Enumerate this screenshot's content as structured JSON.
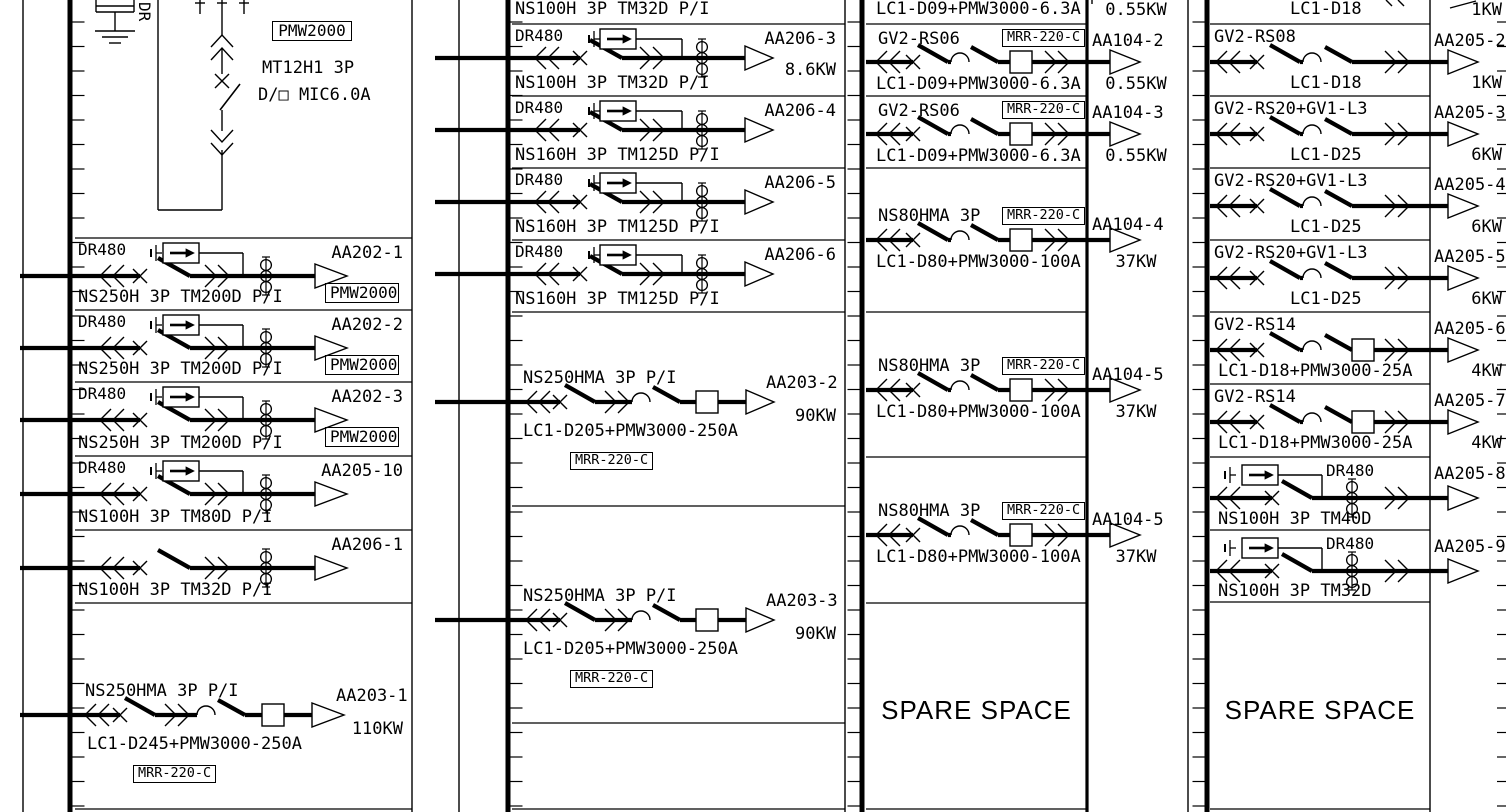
{
  "colors": {
    "ink": "#000000",
    "paper": "#ffffff"
  },
  "incoming": {
    "meter_box": "PMW2000",
    "breaker_model": "MT12H1 3P",
    "trip_unit": "D/□ MIC6.0A",
    "vertical_tag": "DR"
  },
  "columns": [
    {
      "name": "panel-column-1",
      "rows": [
        {
          "kind": "feeder_dr",
          "top": "DR480",
          "bottom": "NS250H 3P TM200D P/I",
          "circuit": "AA202-1",
          "meter": "PMW2000"
        },
        {
          "kind": "feeder_dr",
          "top": "DR480",
          "bottom": "NS250H 3P TM200D P/I",
          "circuit": "AA202-2",
          "meter": "PMW2000"
        },
        {
          "kind": "feeder_dr",
          "top": "DR480",
          "bottom": "NS250H 3P TM200D P/I",
          "circuit": "AA202-3",
          "meter": "PMW2000"
        },
        {
          "kind": "feeder_dr",
          "top": "DR480",
          "bottom": "NS100H 3P TM80D P/I",
          "circuit": "AA205-10"
        },
        {
          "kind": "feeder",
          "bottom": "NS100H 3P TM32D P/I",
          "circuit": "AA206-1"
        },
        {
          "kind": "motor",
          "top": "NS250HMA 3P P/I",
          "bottom": "LC1-D245+PMW3000-250A",
          "relay": "MRR-220-C",
          "circuit": "AA203-1",
          "power": "110KW"
        }
      ]
    },
    {
      "name": "panel-column-2",
      "partial_top": {
        "bottom": "NS100H 3P TM32D P/I"
      },
      "rows": [
        {
          "kind": "feeder_dr",
          "top": "DR480",
          "bottom": "NS100H 3P TM32D P/I",
          "circuit": "AA206-3",
          "power": "8.6KW"
        },
        {
          "kind": "feeder_dr",
          "top": "DR480",
          "bottom": "NS160H 3P TM125D P/I",
          "circuit": "AA206-4"
        },
        {
          "kind": "feeder_dr",
          "top": "DR480",
          "bottom": "NS160H 3P TM125D P/I",
          "circuit": "AA206-5"
        },
        {
          "kind": "feeder_dr",
          "top": "DR480",
          "bottom": "NS160H 3P TM125D P/I",
          "circuit": "AA206-6"
        },
        {
          "kind": "motor",
          "top": "NS250HMA 3P P/I",
          "bottom": "LC1-D205+PMW3000-250A",
          "relay": "MRR-220-C",
          "circuit": "AA203-2",
          "power": "90KW"
        },
        {
          "kind": "motor",
          "top": "NS250HMA 3P P/I",
          "bottom": "LC1-D205+PMW3000-250A",
          "relay": "MRR-220-C",
          "circuit": "AA203-3",
          "power": "90KW"
        },
        {
          "kind": "empty"
        }
      ]
    },
    {
      "name": "panel-column-3",
      "partial_top": {
        "bottom": "LC1-D09+PMW3000-6.3A",
        "power": "0.55KW"
      },
      "rows": [
        {
          "kind": "gv",
          "top": "GV2-RS06",
          "relay": "MRR-220-C",
          "bottom": "LC1-D09+PMW3000-6.3A",
          "circuit": "AA104-2",
          "power": "0.55KW"
        },
        {
          "kind": "gv",
          "top": "GV2-RS06",
          "relay": "MRR-220-C",
          "bottom": "LC1-D09+PMW3000-6.3A",
          "circuit": "AA104-3",
          "power": "0.55KW"
        },
        {
          "kind": "ns80",
          "top": "NS80HMA 3P",
          "relay": "MRR-220-C",
          "bottom": "LC1-D80+PMW3000-100A",
          "circuit": "AA104-4",
          "power": "37KW"
        },
        {
          "kind": "ns80",
          "top": "NS80HMA 3P",
          "relay": "MRR-220-C",
          "bottom": "LC1-D80+PMW3000-100A",
          "circuit": "AA104-5",
          "power": "37KW"
        },
        {
          "kind": "ns80",
          "top": "NS80HMA 3P",
          "relay": "MRR-220-C",
          "bottom": "LC1-D80+PMW3000-100A",
          "circuit": "AA104-5",
          "power": "37KW"
        }
      ],
      "spare_label": "SPARE SPACE"
    },
    {
      "name": "panel-column-4",
      "partial_top": {
        "bottom": "LC1-D18",
        "power": "1KW"
      },
      "rows": [
        {
          "kind": "gv4",
          "top": "GV2-RS08",
          "bottom": "LC1-D18",
          "circuit": "AA205-2",
          "power": "1KW"
        },
        {
          "kind": "gv4",
          "top": "GV2-RS20+GV1-L3",
          "bottom": "LC1-D25",
          "circuit": "AA205-3",
          "power": "6KW"
        },
        {
          "kind": "gv4",
          "top": "GV2-RS20+GV1-L3",
          "bottom": "LC1-D25",
          "circuit": "AA205-4",
          "power": "6KW"
        },
        {
          "kind": "gv4",
          "top": "GV2-RS20+GV1-L3",
          "bottom": "LC1-D25",
          "circuit": "AA205-5",
          "power": "6KW"
        },
        {
          "kind": "gv4",
          "top": "GV2-RS14",
          "bottom": "LC1-D18+PMW3000-25A",
          "circuit": "AA205-6",
          "power": "4KW"
        },
        {
          "kind": "gv4",
          "top": "GV2-RS14",
          "bottom": "LC1-D18+PMW3000-25A",
          "circuit": "AA205-7",
          "power": "4KW"
        },
        {
          "kind": "dr4",
          "top": "DR480",
          "bottom": "NS100H 3P TM40D",
          "circuit": "AA205-8"
        },
        {
          "kind": "dr4",
          "top": "DR480",
          "bottom": "NS100H 3P TM32D",
          "circuit": "AA205-9"
        }
      ],
      "spare_label": "SPARE SPACE"
    }
  ]
}
